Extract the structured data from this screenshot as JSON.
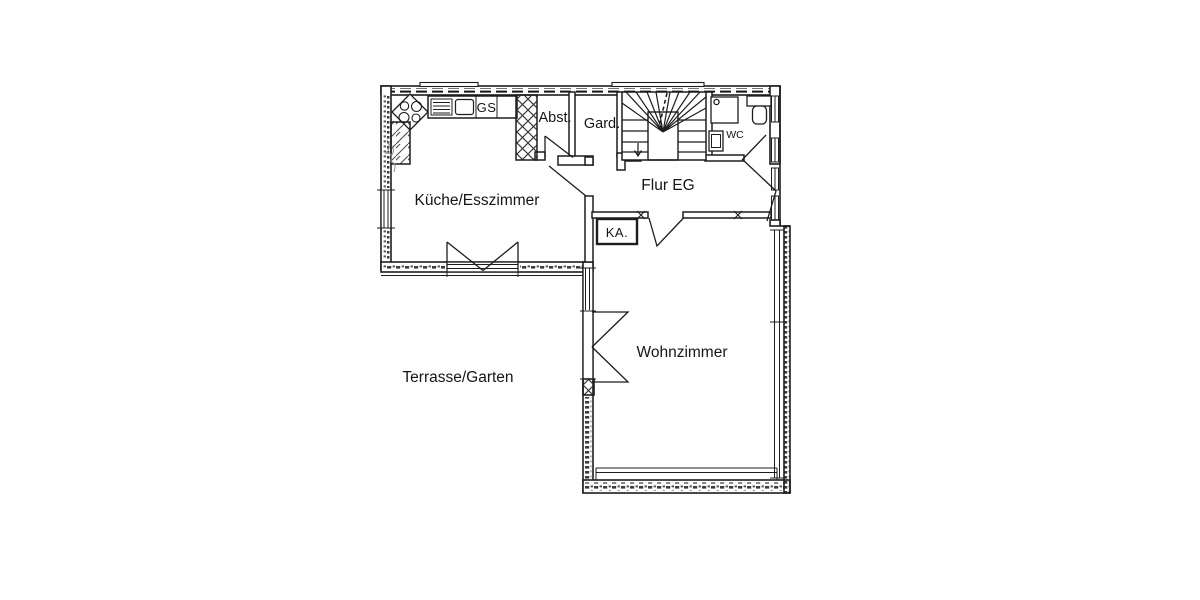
{
  "meta": {
    "type": "floor-plan",
    "floor": "ground floor (EG)",
    "ink_color": "#1d1d1d",
    "paper_color": "#fefefe"
  },
  "labels": {
    "kitchen": "Küche/Esszimmer",
    "storage": "Abst.",
    "wardrobe": "Gard.",
    "hallway": "Flur EG",
    "wc": "WC",
    "chimney": "KA.",
    "dishwasher": "GS",
    "living_room": "Wohnzimmer",
    "terrace": "Terrasse/Garten"
  },
  "fixtures": {
    "stove": "corner-stove-4-burners",
    "sink": "kitchen-sink-with-drainer",
    "tall_cabinets": "crosshatched-tall-units",
    "stairs": "winder-staircase-to-upper-floor",
    "shower": "shower-tray",
    "wash_basin": "wash-basin",
    "toilet": "toilet-with-cistern",
    "doors": "swing-door-symbols",
    "windows": "double-line-window-symbols"
  }
}
